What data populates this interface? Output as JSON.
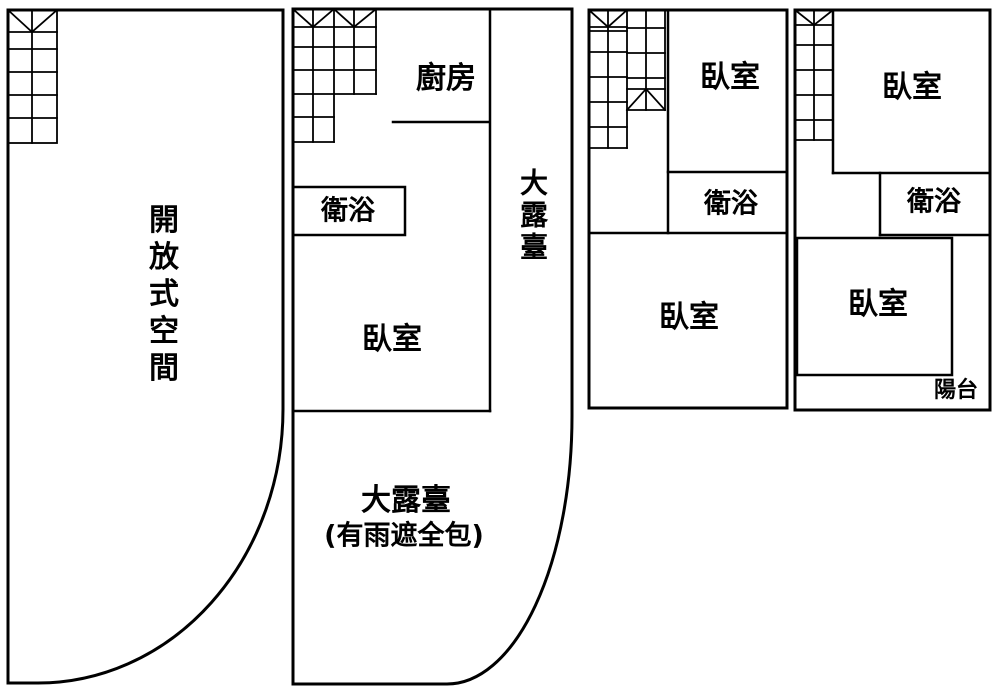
{
  "colors": {
    "line": "#000000",
    "background": "#ffffff"
  },
  "floor1": {
    "open_space": "開放式空間"
  },
  "floor2": {
    "kitchen": "廚房",
    "bathroom": "衛浴",
    "bedroom": "臥室",
    "side_terrace": "大露臺",
    "big_terrace_line1": "大露臺",
    "big_terrace_line2": "(有雨遮全包)"
  },
  "floor3": {
    "bedroom_top": "臥室",
    "bathroom": "衛浴",
    "bedroom_bottom": "臥室"
  },
  "floor4": {
    "bedroom_top": "臥室",
    "bathroom": "衛浴",
    "bedroom": "臥室",
    "balcony": "陽台"
  }
}
